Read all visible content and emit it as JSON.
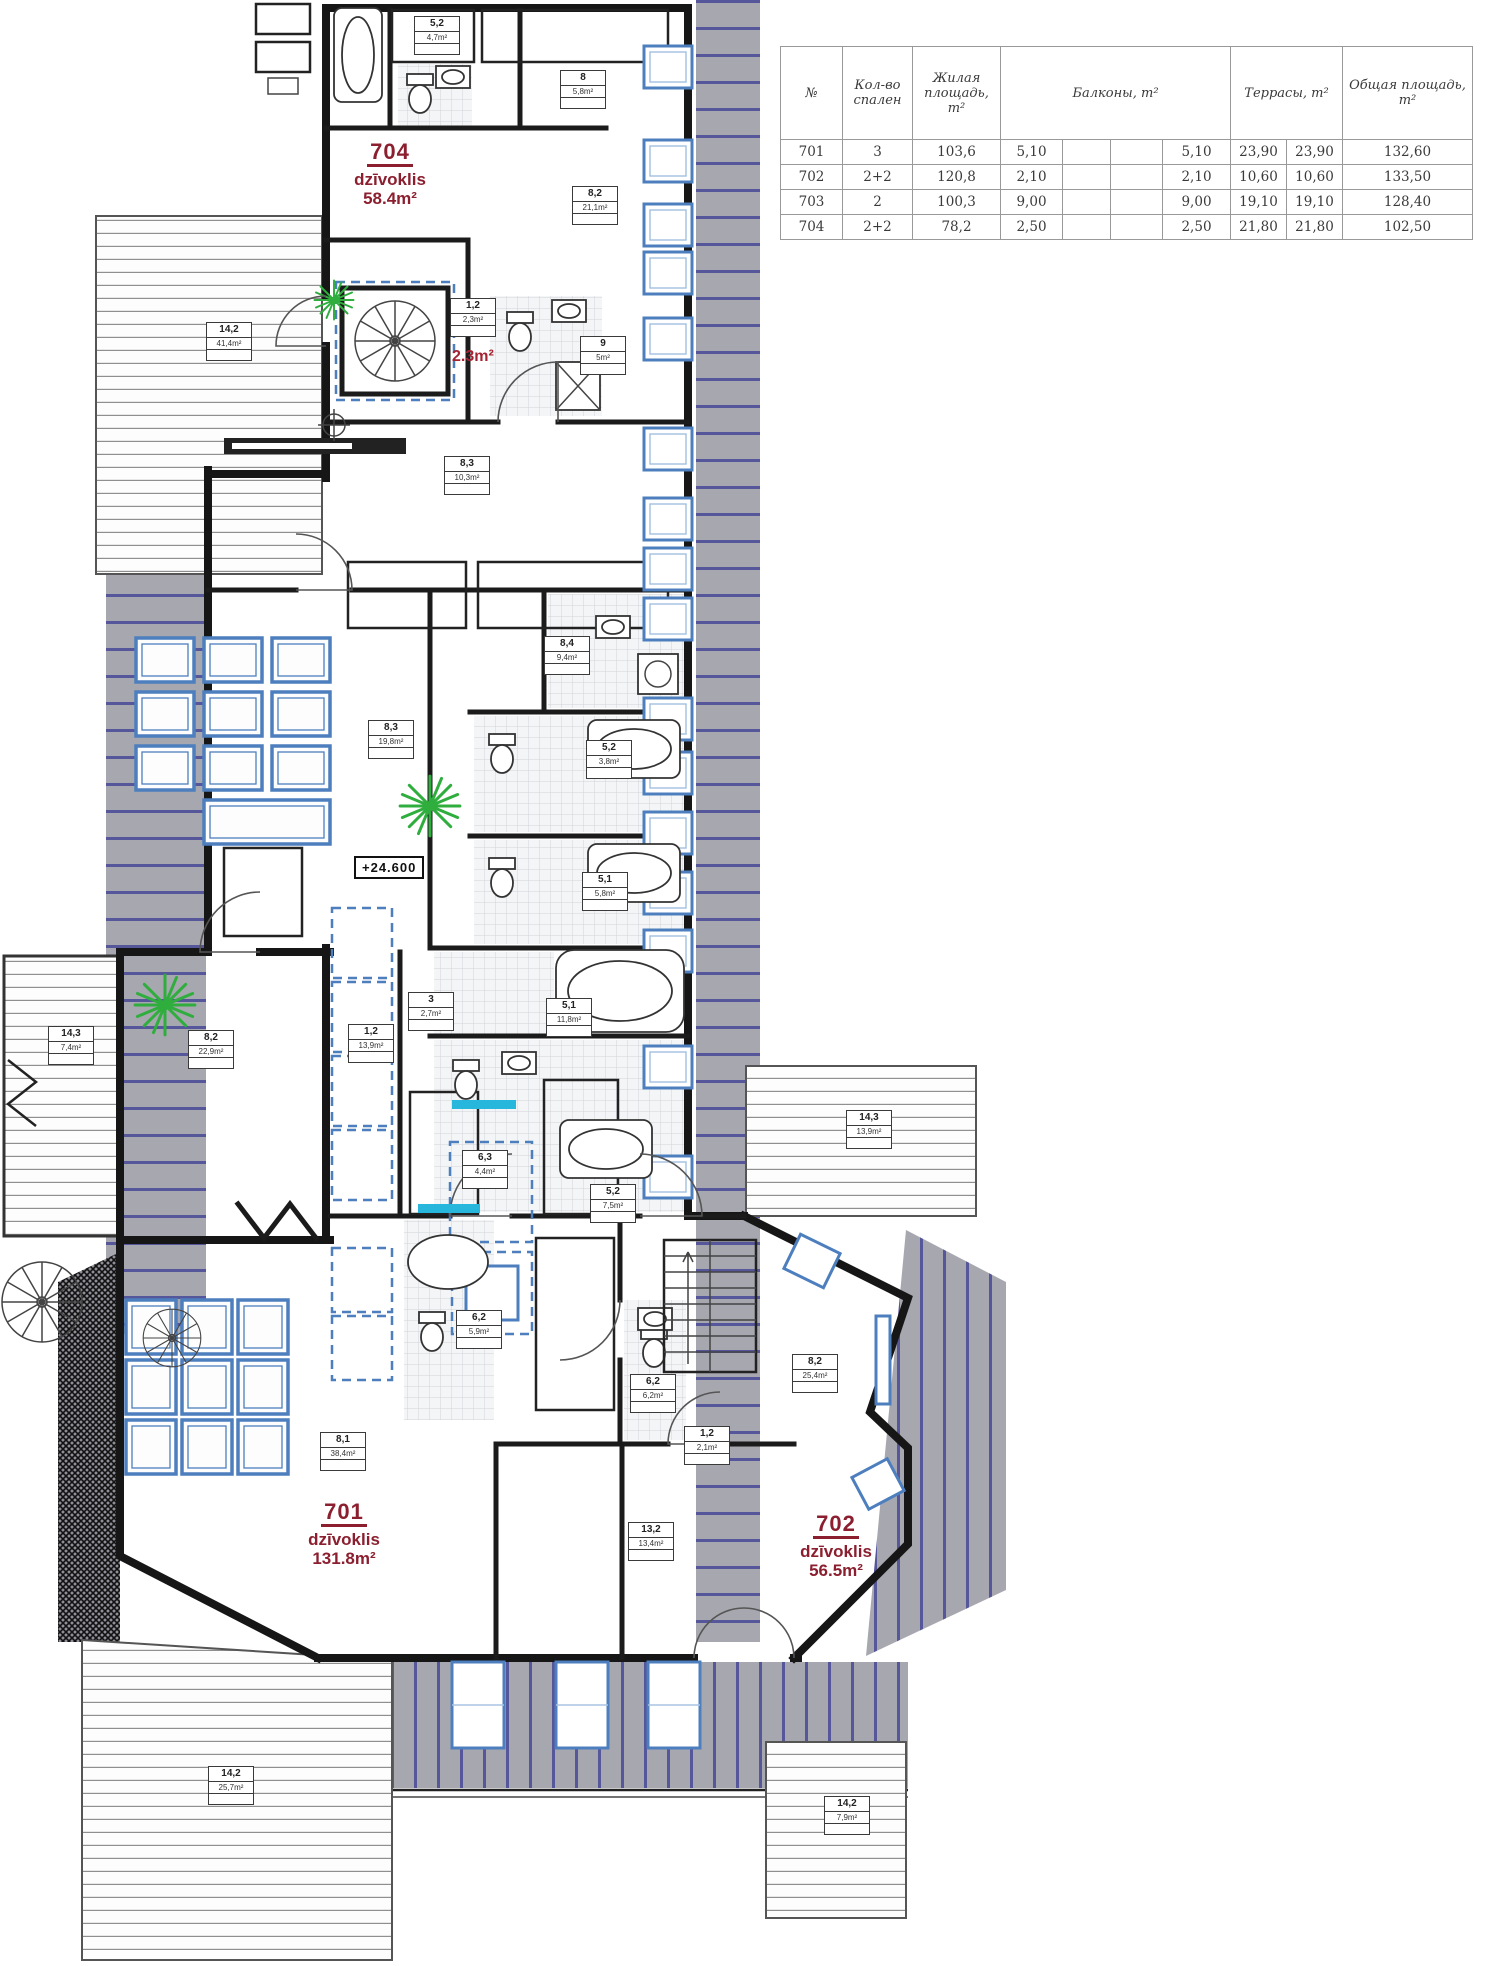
{
  "table": {
    "headers": {
      "num": "№",
      "bedrooms": "Кол-во спален",
      "living": "Жилая площадь, m²",
      "balconies": "Балконы, m²",
      "terraces": "Террасы, m²",
      "total": "Общая площадь, m²"
    },
    "rows": [
      {
        "num": "701",
        "bedrooms": "3",
        "living": "103,6",
        "balc1": "5,10",
        "balc2": "",
        "balc3": "",
        "balc_total": "5,10",
        "terr1": "23,90",
        "terr2": "23,90",
        "total": "132,60"
      },
      {
        "num": "702",
        "bedrooms": "2+2",
        "living": "120,8",
        "balc1": "2,10",
        "balc2": "",
        "balc3": "",
        "balc_total": "2,10",
        "terr1": "10,60",
        "terr2": "10,60",
        "total": "133,50"
      },
      {
        "num": "703",
        "bedrooms": "2",
        "living": "100,3",
        "balc1": "9,00",
        "balc2": "",
        "balc3": "",
        "balc_total": "9,00",
        "terr1": "19,10",
        "terr2": "19,10",
        "total": "128,40"
      },
      {
        "num": "704",
        "bedrooms": "2+2",
        "living": "78,2",
        "balc1": "2,50",
        "balc2": "",
        "balc3": "",
        "balc_total": "2,50",
        "terr1": "21,80",
        "terr2": "21,80",
        "total": "102,50"
      }
    ]
  },
  "apartments": {
    "a704": {
      "number": "704",
      "type": "dzīvoklis",
      "area": "58.4m²"
    },
    "a701": {
      "number": "701",
      "type": "dzīvoklis",
      "area": "131.8m²"
    },
    "a702": {
      "number": "702",
      "type": "dzīvoklis",
      "area": "56.5m²"
    }
  },
  "annotations": {
    "elevation": "+24.600",
    "stair_area": "2.3m²"
  },
  "plan": {
    "rooms": [
      {
        "num": "5,2",
        "area": "4,7m²",
        "x": 414,
        "y": 16
      },
      {
        "num": "8",
        "area": "5,8m²",
        "x": 560,
        "y": 70
      },
      {
        "num": "8,2",
        "area": "21,1m²",
        "x": 572,
        "y": 186
      },
      {
        "num": "1,2",
        "area": "2,3m²",
        "x": 450,
        "y": 298
      },
      {
        "num": "9",
        "area": "5m²",
        "x": 580,
        "y": 336
      },
      {
        "num": "8,3",
        "area": "10,3m²",
        "x": 444,
        "y": 456
      },
      {
        "num": "14,2",
        "area": "41,4m²",
        "x": 206,
        "y": 322
      },
      {
        "num": "8,4",
        "area": "9,4m²",
        "x": 544,
        "y": 636
      },
      {
        "num": "8,3",
        "area": "19,8m²",
        "x": 368,
        "y": 720
      },
      {
        "num": "5,2",
        "area": "3,8m²",
        "x": 586,
        "y": 740
      },
      {
        "num": "5,1",
        "area": "5,8m²",
        "x": 582,
        "y": 872
      },
      {
        "num": "3",
        "area": "2,7m²",
        "x": 408,
        "y": 992
      },
      {
        "num": "1,2",
        "area": "13,9m²",
        "x": 348,
        "y": 1024
      },
      {
        "num": "8,2",
        "area": "22,9m²",
        "x": 188,
        "y": 1030
      },
      {
        "num": "14,3",
        "area": "7,4m²",
        "x": 48,
        "y": 1026
      },
      {
        "num": "5,1",
        "area": "11,8m²",
        "x": 546,
        "y": 998
      },
      {
        "num": "6,3",
        "area": "4,4m²",
        "x": 462,
        "y": 1150
      },
      {
        "num": "5,2",
        "area": "7,5m²",
        "x": 590,
        "y": 1184
      },
      {
        "num": "14,3",
        "area": "13,9m²",
        "x": 846,
        "y": 1110
      },
      {
        "num": "6,2",
        "area": "5,9m²",
        "x": 456,
        "y": 1310
      },
      {
        "num": "8,2",
        "area": "25,4m²",
        "x": 792,
        "y": 1354
      },
      {
        "num": "6,2",
        "area": "6,2m²",
        "x": 630,
        "y": 1374
      },
      {
        "num": "1,2",
        "area": "2,1m²",
        "x": 684,
        "y": 1426
      },
      {
        "num": "8,1",
        "area": "38,4m²",
        "x": 320,
        "y": 1432
      },
      {
        "num": "13,2",
        "area": "13,4m²",
        "x": 628,
        "y": 1522
      },
      {
        "num": "14,2",
        "area": "25,7m²",
        "x": 208,
        "y": 1766
      },
      {
        "num": "14,2",
        "area": "7,9m²",
        "x": 824,
        "y": 1796
      }
    ]
  },
  "colors": {
    "apartment_label": "#8b1f2f",
    "window_blue": "#4d7fbe",
    "roof_gray": "#a7a7af",
    "roof_line": "#56569a",
    "plant_green": "#2fae3e",
    "cyan": "#27b7dc",
    "wall": "#161616"
  }
}
